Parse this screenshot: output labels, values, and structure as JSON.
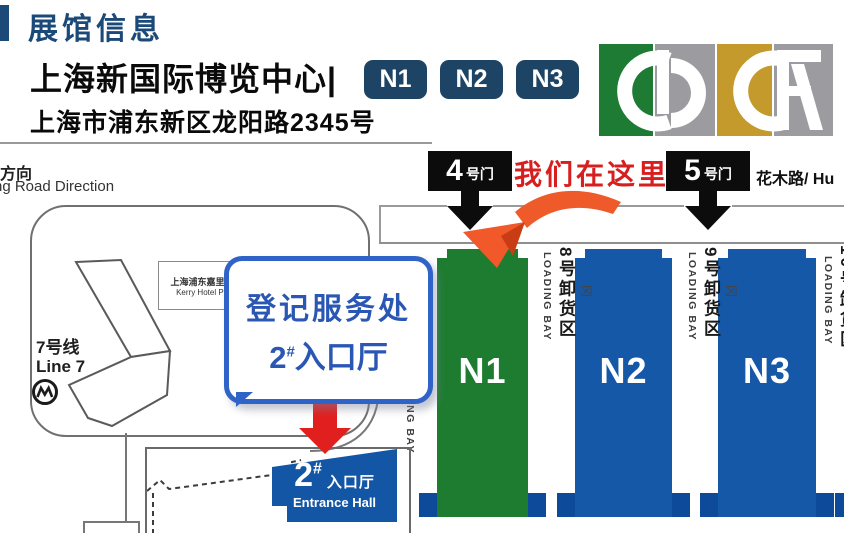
{
  "header": {
    "section_title": "展馆信息",
    "venue_name": "上海新国际博览中心|",
    "hall_badges": [
      "N1",
      "N2",
      "N3"
    ],
    "address": "上海市浦东新区龙阳路2345号"
  },
  "map": {
    "direction_label_cn": "方向",
    "direction_label_en": "ng Road Direction",
    "right_road_label": "花木路/ Hu",
    "here_label": "我们在这里",
    "gates": [
      {
        "number": "4",
        "suffix": "号门"
      },
      {
        "number": "5",
        "suffix": "号门"
      }
    ],
    "metro": {
      "line_cn": "7号线",
      "line_en": "Line 7"
    },
    "hotel": {
      "name_cn": "上海浦东嘉里大酒店",
      "name_en": "Kerry Hotel Pudong"
    },
    "bubble": {
      "line1": "登记服务处",
      "line2_num": "2",
      "line2_sup": "#",
      "line2_rest": "入口厅"
    },
    "halls": [
      {
        "id": "N1",
        "color": "#1e7c31"
      },
      {
        "id": "N2",
        "color": "#1558a8"
      },
      {
        "id": "N3",
        "color": "#1558a8"
      }
    ],
    "dock_glyph": "冈",
    "loading_bays": [
      {
        "cn": "",
        "en": "LOADING BAY"
      },
      {
        "cn": "8号卸货区",
        "en": "LOADING BAY"
      },
      {
        "cn": "9号卸货区",
        "en": "LOADING BAY"
      },
      {
        "cn": "10号卸货区",
        "en": "LOADING BAY"
      }
    ],
    "entrance_sign": {
      "num": "2",
      "sup": "#",
      "cn": "入口厅",
      "en": "Entrance Hall"
    }
  },
  "colors": {
    "accent_blue": "#1c4a78",
    "badge_navy": "#1d4464",
    "hall_green": "#1e7c31",
    "hall_blue": "#1558a8",
    "hall_foot_blue": "#0d4a99",
    "bubble_border_blue": "#2f63c8",
    "bubble_text_blue": "#2b57b4",
    "entrance_sign_blue": "#1356a6",
    "alert_red": "#d81f1f",
    "arrow_red": "#e21f1f",
    "arrow_orange": "#ef5a2b",
    "gate_black": "#0c0c0c",
    "logo_green": "#1e7b33",
    "logo_gold": "#c49a2c",
    "logo_gray": "#9c9ca0"
  }
}
